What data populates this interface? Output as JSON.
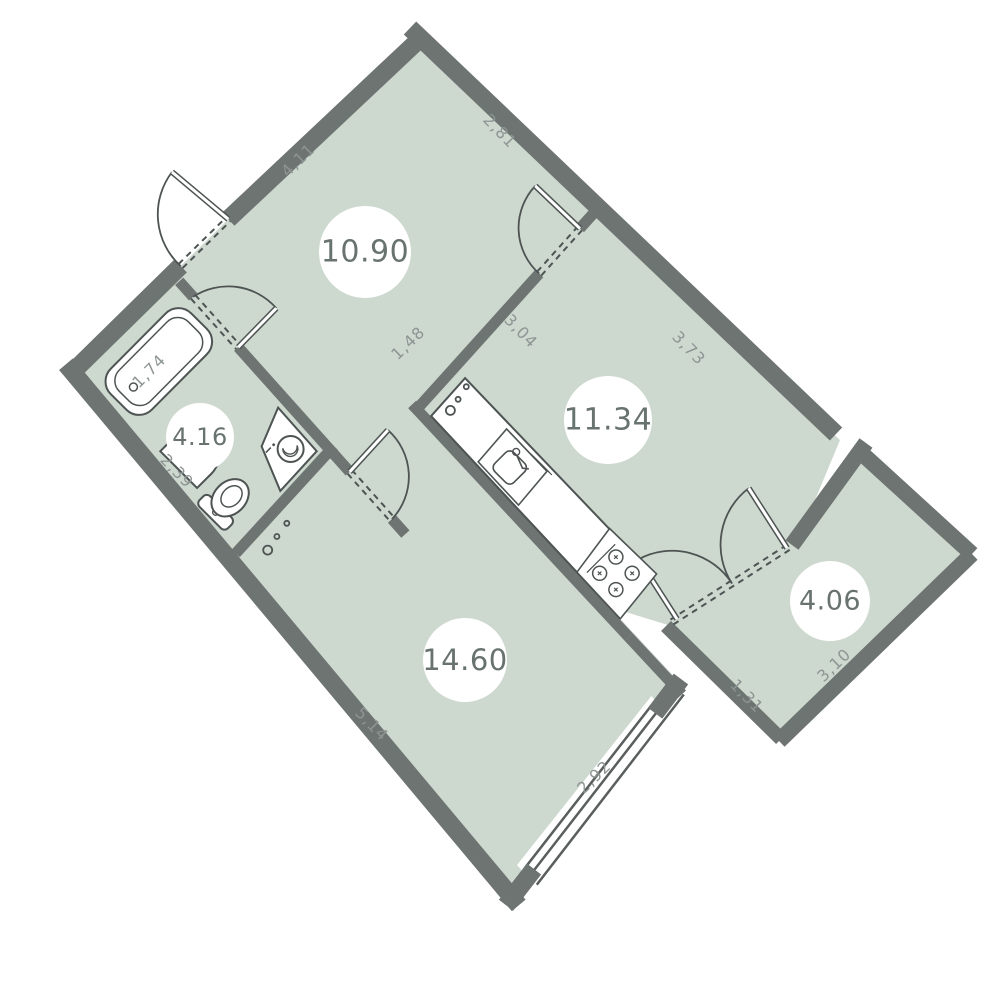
{
  "title": "apartment-floor-plan",
  "colors": {
    "background": "#ffffff",
    "wall": "#6e7472",
    "room_fill": "#cdd8cf",
    "fixture_stroke": "#4d5453",
    "fixture_fill": "#ffffff",
    "dim_text": "#8e9594",
    "room_text": "#68736f",
    "circle_fill": "#ffffff",
    "window_line": "#5a5f5e"
  },
  "rooms": [
    {
      "name": "hall",
      "area": "10.90",
      "circle": {
        "x": 365,
        "y": 252,
        "r": 46,
        "fs": 30
      },
      "poly": [
        [
          168.7,
          277.8
        ],
        [
          413.6,
          37.2
        ],
        [
          601.6,
          213.9
        ],
        [
          355.6,
          486.9
        ]
      ]
    },
    {
      "name": "bathroom",
      "area": "4.16",
      "circle": {
        "x": 200,
        "y": 437,
        "r": 34,
        "fs": 24
      },
      "poly": [
        [
          72.6,
          372.1
        ],
        [
          176.3,
          270.1
        ],
        [
          338.0,
          450.8
        ],
        [
          233.9,
          564.9
        ]
      ]
    },
    {
      "name": "kitchen",
      "area": "11.34",
      "circle": {
        "x": 608,
        "y": 420,
        "r": 44,
        "fs": 30
      },
      "poly": [
        [
          408.6,
          408.2
        ],
        [
          592.2,
          205.2
        ],
        [
          840,
          440
        ],
        [
          795,
          548
        ],
        [
          668,
          625
        ],
        [
          587,
          600
        ]
      ]
    },
    {
      "name": "living-room",
      "area": "14.60",
      "circle": {
        "x": 465,
        "y": 660,
        "r": 42,
        "fs": 29
      },
      "poly": [
        [
          224.6,
          553.8
        ],
        [
          390.8,
          372.9
        ],
        [
          681.3,
          684.1
        ],
        [
          514.1,
          899.9
        ]
      ]
    },
    {
      "name": "balcony",
      "area": "4.06",
      "circle": {
        "x": 830,
        "y": 601,
        "r": 40,
        "fs": 27
      },
      "poly": [
        [
          672,
          622
        ],
        [
          792,
          545
        ],
        [
          855,
          455
        ],
        [
          962,
          556
        ],
        [
          778,
          734
        ]
      ]
    }
  ],
  "walls": [
    {
      "name": "facade-top-left",
      "pts": [
        [
          66.6,
          377.9
        ],
        [
          180.6,
          266.0
        ]
      ],
      "w": 18
    },
    {
      "name": "facade-top-right",
      "pts": [
        [
          228.3,
          219.2
        ],
        [
          424,
          35
        ]
      ],
      "w": 18
    },
    {
      "name": "facade-left",
      "pts": [
        [
          66.0,
          364.2
        ],
        [
          518.7,
          905.4
        ]
      ],
      "w": 18
    },
    {
      "name": "facade-right",
      "pts": [
        [
          410,
          28
        ],
        [
          836,
          434
        ]
      ],
      "w": 18
    },
    {
      "name": "facade-bottom-stub-left",
      "pts": [
        [
          506.0,
          905.2
        ],
        [
          534,
          869
        ]
      ],
      "w": 18
    },
    {
      "name": "facade-bottom-stub-right",
      "pts": [
        [
          655.1,
          713.2
        ],
        [
          681,
          679
        ]
      ],
      "w": 18
    },
    {
      "name": "bath-partition-top",
      "pts": [
        [
          179.2,
          281.3
        ],
        [
          193.1,
          296.8
        ]
      ],
      "w": 11
    },
    {
      "name": "bath-partition-bottom",
      "pts": [
        [
          238.2,
          347.2
        ],
        [
          330.1,
          449.9
        ]
      ],
      "w": 11
    },
    {
      "name": "bath-bottom-wall",
      "pts": [
        [
          235.7,
          553.4
        ],
        [
          333.9,
          446.2
        ]
      ],
      "w": 11
    },
    {
      "name": "living-door-wall-top",
      "pts": [
        [
          330.1,
          449.9
        ],
        [
          349.7,
          471.8
        ]
      ],
      "w": 11
    },
    {
      "name": "living-door-wall-bottom",
      "pts": [
        [
          392.0,
          519.1
        ],
        [
          405.4,
          534.1
        ]
      ],
      "w": 11
    },
    {
      "name": "kitchen-left-wall",
      "pts": [
        [
          412.2,
          404.4
        ],
        [
          628.8,
          637.1
        ]
      ],
      "w": 11
    },
    {
      "name": "living-right-wall-lower",
      "pts": [
        [
          628.8,
          637.1
        ],
        [
          682.0,
          694.3
        ]
      ],
      "w": 11
    },
    {
      "name": "kitchen-top-partition",
      "pts": [
        [
          413.3,
          413.2
        ],
        [
          539.2,
          273.6
        ]
      ],
      "w": 11
    },
    {
      "name": "kitchen-top-pier",
      "pts": [
        [
          579.9,
          228.4
        ],
        [
          596.9,
          209.6
        ]
      ],
      "w": 11
    },
    {
      "name": "balcony-top-solid",
      "pts": [
        [
          792,
          545
        ],
        [
          866,
          443
        ]
      ],
      "w": 16
    },
    {
      "name": "balcony-right-wall",
      "pts": [
        [
          857,
          449
        ],
        [
          972,
          554
        ]
      ],
      "w": 16
    },
    {
      "name": "balcony-bottom-wall",
      "pts": [
        [
          972,
          554
        ],
        [
          779,
          741
        ]
      ],
      "w": 16
    },
    {
      "name": "balcony-left-wall",
      "pts": [
        [
          781,
          739
        ],
        [
          666,
          626
        ]
      ],
      "w": 14
    }
  ],
  "doors": [
    {
      "name": "entry-door",
      "leaf": [
        [
          228.3,
          219.2
        ],
        [
          172,
          172
        ]
      ],
      "arc": "M172,172 A70,70 0 0 0 180.6,266.0",
      "dashes": [
        [
          [
            182.6,
            268.0
          ],
          [
            230.3,
            221.2
          ]
        ],
        [
          [
            178.6,
            264.0
          ],
          [
            226.3,
            217.2
          ]
        ]
      ]
    },
    {
      "name": "bathroom-door",
      "leaf": [
        [
          238.2,
          347.2
        ],
        [
          276.3,
          308.2
        ]
      ],
      "arc": "M276.3,308.2 A64,64 0 0 0 193.1,296.8",
      "dashes": [
        [
          [
            191.0,
            298.7
          ],
          [
            236.1,
            349.1
          ]
        ],
        [
          [
            195.2,
            294.9
          ],
          [
            240.3,
            345.3
          ]
        ]
      ]
    },
    {
      "name": "living-room-door",
      "leaf": [
        [
          349.7,
          471.8
        ],
        [
          387.9,
          430.1
        ]
      ],
      "arc": "M387.9,430.1 A62,62 0 0 1 392.0,519.1",
      "dashes": [
        [
          [
            351.8,
            469.9
          ],
          [
            394.1,
            517.2
          ]
        ],
        [
          [
            347.6,
            473.7
          ],
          [
            389.9,
            521.0
          ]
        ]
      ]
    },
    {
      "name": "kitchen-door",
      "leaf": [
        [
          579.9,
          228.4
        ],
        [
          535.3,
          185.9
        ]
      ],
      "arc": "M535.3,185.9 A61,61 0 0 0 539.2,273.6",
      "dashes": [
        [
          [
            541.3,
            275.5
          ],
          [
            582.0,
            230.3
          ]
        ],
        [
          [
            537.1,
            271.7
          ],
          [
            577.8,
            226.5
          ]
        ]
      ]
    },
    {
      "name": "balcony-door-left",
      "leaf": [
        [
          677,
          619
        ],
        [
          638.7,
          559.2
        ]
      ],
      "arc": "M638.7,559.2 A71,71 0 0 1 732,583.5",
      "dashes": [
        [
          [
            673.5,
            624.4
          ],
          [
            793.5,
            547.4
          ]
        ],
        [
          [
            670.5,
            619.6
          ],
          [
            790.5,
            542.6
          ]
        ]
      ]
    },
    {
      "name": "balcony-door-right",
      "leaf": [
        [
          787,
          548
        ],
        [
          748.7,
          488.2
        ]
      ],
      "arc": "M748.7,488.2 A71,71 0 0 0 732,583.5",
      "dashes": []
    }
  ],
  "window": {
    "name": "living-room-window",
    "white_quad": [
      [
        517,
        865
      ],
      [
        651.4,
        696
      ],
      [
        670,
        718.7
      ],
      [
        538.7,
        889.3
      ]
    ],
    "lines": [
      [
        [
          525.4,
          867.3
        ],
        [
          651.5,
          705.4
        ]
      ],
      [
        [
          531.1,
          874.0
        ],
        [
          657.3,
          711.5
        ]
      ],
      [
        [
          536.8,
          884.7
        ],
        [
          683.8,
          694.5
        ]
      ]
    ]
  },
  "fixtures": {
    "bathtub": {
      "cx": 158.8,
      "cy": 361.5,
      "rot": -45.2
    },
    "bath_sink": {
      "cx": 191.4,
      "cy": 456.9,
      "rot": -45
    },
    "toilet": {
      "cx": 230.1,
      "cy": 497.8,
      "rot": -45
    },
    "washing_machine": {
      "poly": [
        [
          261.6,
          446.4
        ],
        [
          278.1,
          407.6
        ],
        [
          316.7,
          451.2
        ],
        [
          280.3,
          490.9
        ]
      ],
      "cx": 289.2,
      "cy": 449.0,
      "rot": -45
    },
    "counter": {
      "poly": [
        [
          431.1,
          416.1
        ],
        [
          465.1,
          378.1
        ],
        [
          653.5,
          575.1
        ],
        [
          619.3,
          617.6
        ]
      ]
    },
    "kitchen_sink": {
      "poly": [
        [
          478.2,
          461.9
        ],
        [
          506.6,
          429.0
        ],
        [
          547.0,
          471.3
        ],
        [
          518.5,
          505.1
        ]
      ],
      "cx": 512.6,
      "cy": 466.8,
      "rot": -45
    },
    "stove": {
      "poly": [
        [
          576.9,
          572.2
        ],
        [
          609.6,
          528.5
        ],
        [
          656.6,
          573.9
        ],
        [
          620.3,
          618.8
        ]
      ],
      "cx": 615.9,
      "cy": 573.3,
      "rot": -45
    }
  },
  "riser_dots": [
    [
      [
        450.4,
        410.4,
        4.5
      ],
      [
        458.1,
        399.3,
        2.5
      ],
      [
        466.3,
        386.7,
        2.5
      ]
    ],
    [
      [
        267.7,
        550.1,
        4.5
      ],
      [
        276.9,
        536.5,
        2.5
      ],
      [
        286.8,
        523.3,
        2.5
      ]
    ]
  ],
  "dimensions": [
    {
      "text": "4,11",
      "x": 298,
      "y": 160,
      "rot": -44
    },
    {
      "text": "2,81",
      "x": 500,
      "y": 131,
      "rot": 46
    },
    {
      "text": "1,48",
      "x": 408,
      "y": 343,
      "rot": -44
    },
    {
      "text": "3,04",
      "x": 521,
      "y": 331,
      "rot": 46
    },
    {
      "text": "3,73",
      "x": 689,
      "y": 348,
      "rot": 46
    },
    {
      "text": "1,74",
      "x": 149,
      "y": 371,
      "rot": -45
    },
    {
      "text": "2,39",
      "x": 177,
      "y": 471,
      "rot": 46
    },
    {
      "text": "5,14",
      "x": 372,
      "y": 724,
      "rot": 46
    },
    {
      "text": "2,92",
      "x": 594,
      "y": 777,
      "rot": -44
    },
    {
      "text": "1,31",
      "x": 747,
      "y": 696,
      "rot": 46
    },
    {
      "text": "3,10",
      "x": 834,
      "y": 665,
      "rot": -44
    }
  ],
  "dim_font_size": 16,
  "fixture_line_width": 2
}
